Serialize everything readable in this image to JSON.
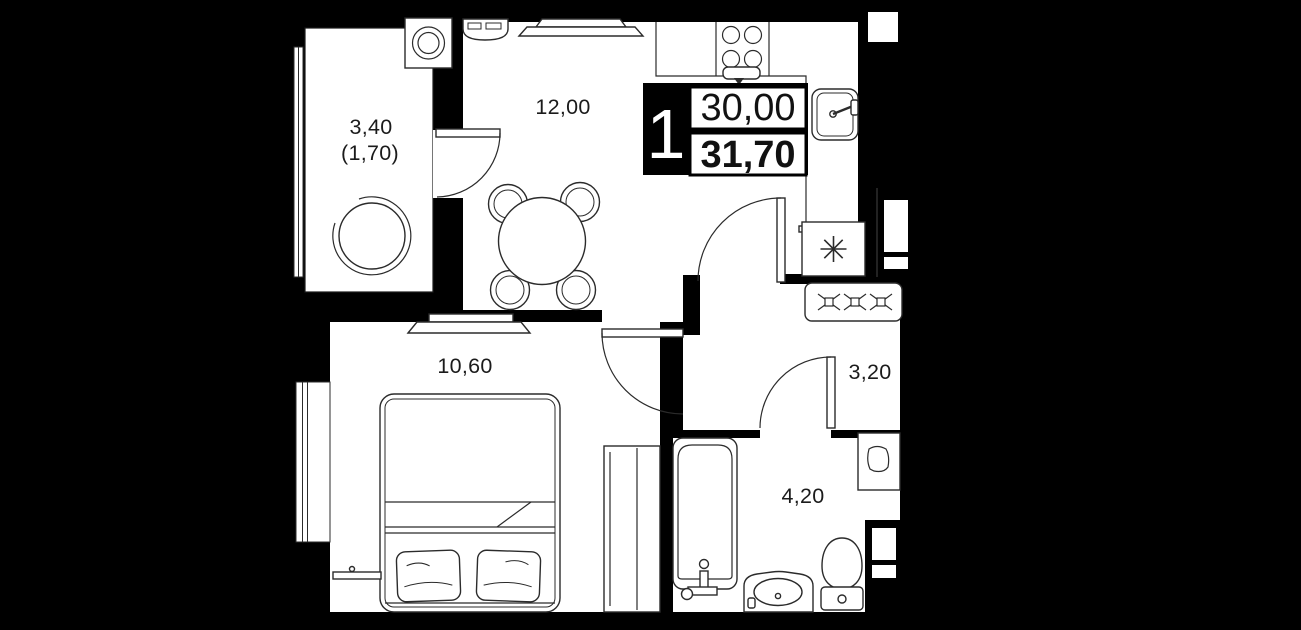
{
  "floorplan": {
    "badge": {
      "room_count": "1",
      "area_primary": "30,00",
      "area_total": "31,70"
    },
    "labels": {
      "balcony_area": "3,40",
      "balcony_area_reduced": "(1,70)",
      "kitchen_living_area": "12,00",
      "bedroom_area": "10,60",
      "hallway_area": "3,20",
      "bathroom_area": "4,20"
    },
    "fixtures": [
      "washing-machine-icon",
      "armchair-icon",
      "tv-icon",
      "kitchen-appliance-icon",
      "stove-icon",
      "sink-icon",
      "fridge-snowflake-icon",
      "vent-shaft-icon",
      "dining-table-icon",
      "chair-icon",
      "bed-icon",
      "pillow-icon",
      "wardrobe-icon",
      "tv-console-icon",
      "radiator-icon",
      "bathtub-icon",
      "washbasin-icon",
      "toilet-icon",
      "water-heater-icon",
      "door-swing-icon",
      "window-icon",
      "entrance-door-icon"
    ],
    "colors": {
      "background": "#000000",
      "floor": "#ffffff",
      "walls": "#000000",
      "linework": "#2b2b2b",
      "label_text": "#1b1b1b",
      "badge_bg": "#000000",
      "badge_text": "#ffffff"
    }
  }
}
